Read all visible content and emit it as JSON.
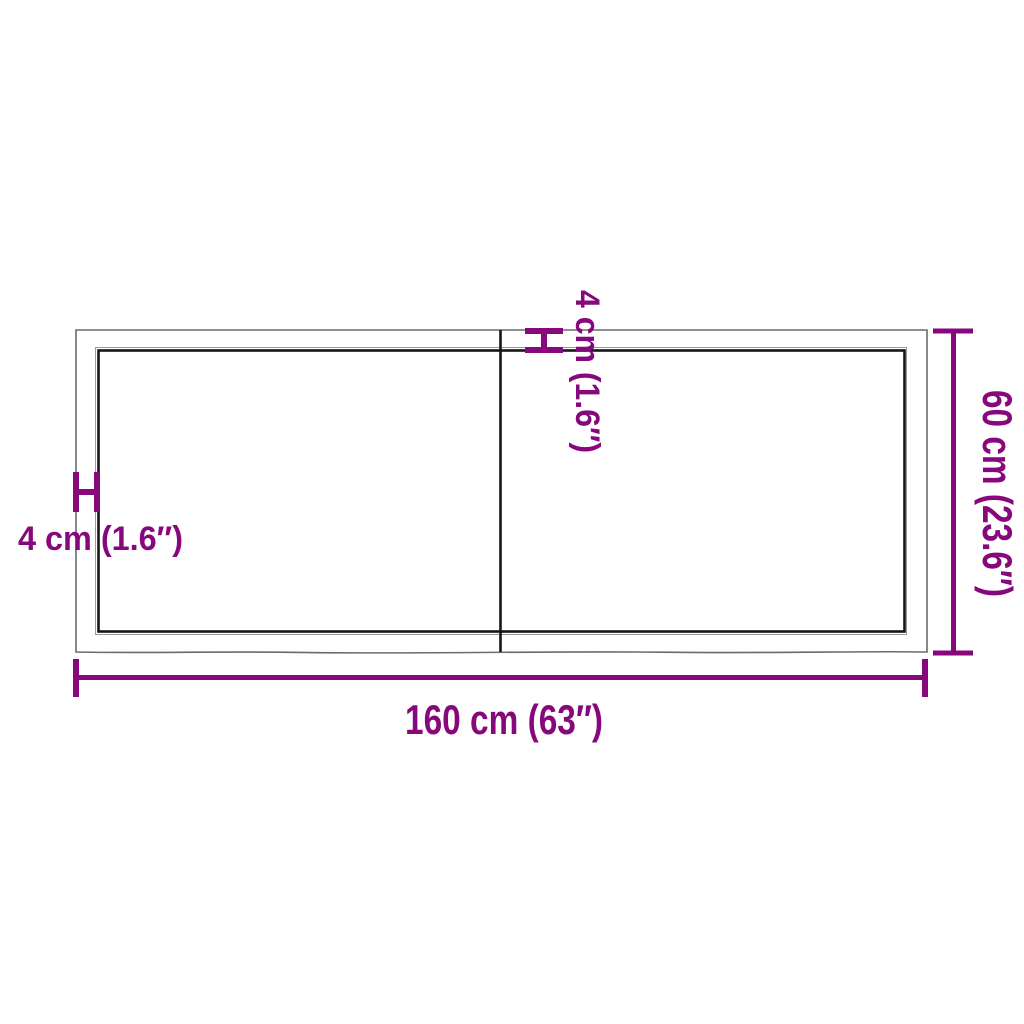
{
  "diagram": {
    "labels": {
      "width": "160 cm (63″)",
      "height": "60 cm (23.6″)",
      "thickness_side": "4 cm (1.6″)",
      "thickness_top": "4 cm (1.6″)"
    },
    "colors": {
      "accent": "#87087D",
      "outline": "#6B6B6B",
      "edge": "#161616",
      "edge_offset": "#9B9B9B",
      "background": "#FFFFFF"
    }
  }
}
